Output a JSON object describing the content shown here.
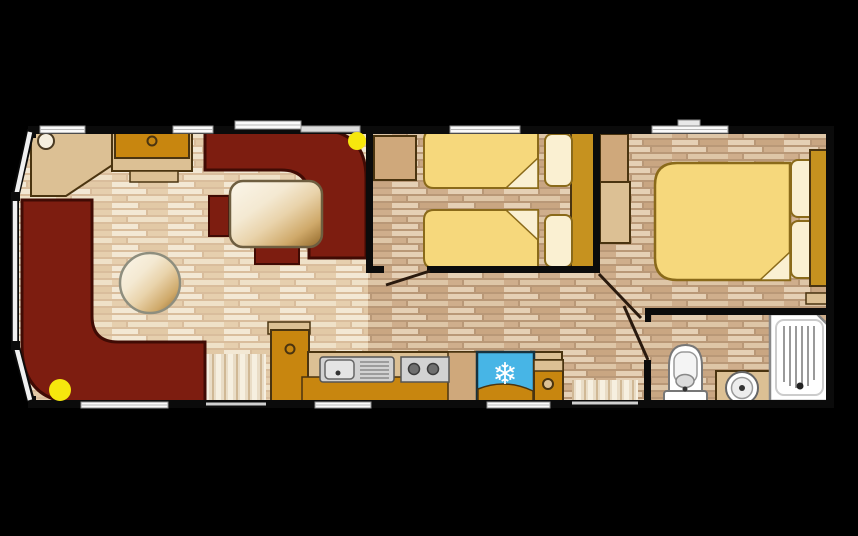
{
  "meta": {
    "type": "floor-plan",
    "subject": "static caravan holiday home floor plan, top-down view",
    "canvas": {
      "w": 858,
      "h": 536
    }
  },
  "colors": {
    "background": "#000000",
    "wall": "#0b0b0b",
    "maroon": "#7d1d10",
    "maroonDark": "#400b04",
    "gold": "#c8860f",
    "headboardGold": "#c6921f",
    "tanLight": "#dcc094",
    "tanMid": "#cfa87b",
    "outline": "#4a3410",
    "bedYellow": "#f6d87c",
    "bedOutline": "#8a6a1a",
    "cream": "#faf0d2",
    "fridgeBlue": "#47b5e6",
    "lightYellow": "#f6e70d",
    "white": "#fafafa",
    "windowFrame": "#8e8e8e",
    "fixtureGray": "#d2d2d2",
    "fixtureEdge": "#555555",
    "doorLeaf": "#2a1a0e"
  },
  "rooms": [
    {
      "name": "lounge"
    },
    {
      "name": "dining-area"
    },
    {
      "name": "kitchen"
    },
    {
      "name": "twin-bedroom"
    },
    {
      "name": "double-bedroom"
    },
    {
      "name": "bathroom"
    },
    {
      "name": "hallway"
    }
  ],
  "icons": [
    {
      "name": "fridge-snowflake-icon",
      "glyph": "❄"
    }
  ],
  "shapes": [
    {
      "n": "floor-lounge",
      "t": "path",
      "d": "M31,130 L16,197 L16,345 L31,401 L368,401 L368,130 Z",
      "fill": "url(#floorLight)"
    },
    {
      "n": "floor-bedrooms-hall",
      "t": "rect",
      "x": 368,
      "y": 130,
      "w": 460,
      "h": 272,
      "fill": "url(#floorDark)"
    },
    {
      "n": "main-door-threshold",
      "t": "rect",
      "x": 206,
      "y": 354,
      "w": 60,
      "h": 48,
      "fill": "url(#mat)"
    },
    {
      "n": "rear-door-threshold",
      "t": "rect",
      "x": 572,
      "y": 380,
      "w": 66,
      "h": 22,
      "fill": "url(#mat)"
    },
    {
      "n": "corner-shelf",
      "t": "polygon",
      "pts": "31,130 114,130 114,164 66,196 31,196",
      "fill": "$tanLight",
      "stroke": "$outline",
      "sw": 2
    },
    {
      "n": "corner-lamp",
      "t": "circle",
      "cx": 46,
      "cy": 141,
      "r": 8,
      "fill": "#f6efdf",
      "stroke": "#4a3a22",
      "sw": 2
    },
    {
      "n": "tv-unit-base",
      "t": "rect",
      "x": 112,
      "y": 130,
      "w": 80,
      "h": 41,
      "fill": "$tanLight",
      "stroke": "$outline",
      "sw": 2
    },
    {
      "n": "tv-unit",
      "t": "rect",
      "x": 115,
      "y": 132,
      "w": 74,
      "h": 26,
      "fill": "$gold",
      "stroke": "$outline",
      "sw": 2
    },
    {
      "n": "tv-unit-knob",
      "t": "circle",
      "cx": 152,
      "cy": 141,
      "r": 4.5,
      "fill": "$gold",
      "stroke": "$outline",
      "sw": 2
    },
    {
      "n": "tv-unit-step",
      "t": "rect",
      "x": 130,
      "y": 171,
      "w": 48,
      "h": 11,
      "fill": "$tanLight",
      "stroke": "$outline",
      "sw": 1.5
    },
    {
      "n": "l-shaped-sofa",
      "t": "path",
      "d": "M22,200 H92 V316 Q92,342 118,342 H205 V403 H80 Q22,403 22,345 Z",
      "fill": "$maroon",
      "stroke": "$maroonDark",
      "sw": 3
    },
    {
      "n": "dining-booth",
      "t": "path",
      "d": "M205,130 H318 Q366,130 366,178 V258 H309 V198 Q309,170 281,170 H205 Z",
      "fill": "$maroon",
      "stroke": "$maroonDark",
      "sw": 3
    },
    {
      "n": "dining-bench-left",
      "t": "rect",
      "x": 209,
      "y": 196,
      "w": 20,
      "h": 40,
      "fill": "$maroon",
      "stroke": "$maroonDark",
      "sw": 2
    },
    {
      "n": "dining-bench-stub",
      "t": "rect",
      "x": 255,
      "y": 247,
      "w": 44,
      "h": 17,
      "fill": "$maroon",
      "stroke": "$maroonDark",
      "sw": 2
    },
    {
      "n": "dining-table",
      "t": "rect",
      "x": 230,
      "y": 181,
      "w": 92,
      "h": 66,
      "rx": 13,
      "fill": "url(#woodGloss)",
      "stroke": "#6e5e40",
      "sw": 2.5
    },
    {
      "n": "round-table",
      "t": "circle",
      "cx": 150,
      "cy": 283,
      "r": 30,
      "fill": "url(#woodGloss)",
      "stroke": "#8e8e7e",
      "sw": 2.5
    },
    {
      "n": "kitchen-tall-cabinet-top",
      "t": "rect",
      "x": 268,
      "y": 322,
      "w": 42,
      "h": 12,
      "fill": "$tanLight",
      "stroke": "$outline",
      "sw": 1.5
    },
    {
      "n": "kitchen-tall-cabinet",
      "t": "rect",
      "x": 271,
      "y": 330,
      "w": 38,
      "h": 73,
      "fill": "$gold",
      "stroke": "$outline",
      "sw": 2
    },
    {
      "n": "kitchen-tall-cabinet-knob",
      "t": "circle",
      "cx": 290,
      "cy": 349,
      "r": 4.5,
      "fill": "$gold",
      "stroke": "$outline",
      "sw": 2
    },
    {
      "n": "kitchen-counter",
      "t": "rect",
      "x": 308,
      "y": 352,
      "w": 254,
      "h": 51,
      "fill": "$tanLight",
      "stroke": "$outline",
      "sw": 2
    },
    {
      "n": "kitchen-base-unit",
      "t": "rect",
      "x": 302,
      "y": 377,
      "w": 260,
      "h": 26,
      "fill": "$gold",
      "stroke": "$outline",
      "sw": 1.5
    },
    {
      "n": "kitchen-divider-unit",
      "t": "rect",
      "x": 448,
      "y": 352,
      "w": 30,
      "h": 51,
      "fill": "$tanMid",
      "stroke": "$outline",
      "sw": 1.5
    },
    {
      "n": "sink-unit",
      "t": "rect",
      "x": 320,
      "y": 357,
      "w": 74,
      "h": 25,
      "rx": 3,
      "fill": "$fixtureGray",
      "stroke": "$fixtureEdge",
      "sw": 1.5
    },
    {
      "n": "sink-bowl",
      "t": "rect",
      "x": 325,
      "y": 360,
      "w": 29,
      "h": 19,
      "rx": 4,
      "fill": "#e4e4e4",
      "stroke": "#666666",
      "sw": 1.5
    },
    {
      "n": "sink-tap",
      "t": "circle",
      "cx": 338,
      "cy": 373,
      "r": 2.5,
      "fill": "#333333"
    },
    {
      "n": "sink-drainer",
      "t": "path",
      "d": "M360,362H389M360,366H389M360,370H389M360,374H389M360,378H389",
      "stroke": "#8a8a8a",
      "sw": 1.5
    },
    {
      "n": "hob",
      "t": "rect",
      "x": 401,
      "y": 357,
      "w": 48,
      "h": 25,
      "fill": "$fixtureGray",
      "stroke": "$fixtureEdge",
      "sw": 1.5
    },
    {
      "n": "hob-burner-left",
      "t": "circle",
      "cx": 414,
      "cy": 369,
      "r": 5.5,
      "fill": "#6f6f6f",
      "stroke": "#3c3c3c",
      "sw": 1.5
    },
    {
      "n": "hob-burner-right",
      "t": "circle",
      "cx": 433,
      "cy": 369,
      "r": 5.5,
      "fill": "#6f6f6f",
      "stroke": "#3c3c3c",
      "sw": 1.5
    },
    {
      "n": "fridge",
      "t": "rect",
      "x": 477,
      "y": 352,
      "w": 57,
      "h": 51,
      "fill": "$fridgeBlue",
      "stroke": "#16323f",
      "sw": 2.5
    },
    {
      "n": "fridge-base",
      "t": "path",
      "d": "M478,402 V389 Q505,378 533,391 V402 Z",
      "fill": "$gold",
      "stroke": "$outline",
      "sw": 1.5
    },
    {
      "n": "fridge-snowflake-icon",
      "t": "text",
      "x": 505,
      "y": 384,
      "content": "❄",
      "size": 30,
      "fill": "#ffffff"
    },
    {
      "n": "kitchen-end-cabinet",
      "t": "rect",
      "x": 534,
      "y": 360,
      "w": 29,
      "h": 43,
      "fill": "$gold",
      "stroke": "$outline",
      "sw": 2
    },
    {
      "n": "kitchen-end-cabinet-top",
      "t": "rect",
      "x": 534,
      "y": 360,
      "w": 29,
      "h": 11,
      "fill": "$tanLight",
      "stroke": "$outline",
      "sw": 1.5
    },
    {
      "n": "kitchen-end-cabinet-knob",
      "t": "circle",
      "cx": 548,
      "cy": 384,
      "r": 5,
      "fill": "$tanLight",
      "stroke": "$outline",
      "sw": 2
    },
    {
      "n": "twin-bedside-cabinet",
      "t": "rect",
      "x": 374,
      "y": 136,
      "w": 42,
      "h": 44,
      "fill": "$tanMid",
      "stroke": "$outline",
      "sw": 2
    },
    {
      "n": "twin-headboard-panel",
      "t": "rect",
      "x": 571,
      "y": 130,
      "w": 25,
      "h": 138,
      "fill": "$headboardGold",
      "stroke": "$outline",
      "sw": 2
    },
    {
      "n": "twin-bed-1",
      "t": "path",
      "d": "M434,130 H538 V188 H434 Q424,188 424,178 V140 Q424,130 434,130 Z",
      "fill": "$bedYellow",
      "stroke": "$bedOutline",
      "sw": 2
    },
    {
      "n": "twin-bed-1-fold",
      "t": "polygon",
      "pts": "538,158 538,188 506,188",
      "fill": "$cream",
      "stroke": "$bedOutline",
      "sw": 1.5
    },
    {
      "n": "twin-pillow-1",
      "t": "rect",
      "x": 545,
      "y": 134,
      "w": 27,
      "h": 52,
      "rx": 7,
      "fill": "$cream",
      "stroke": "$bedOutline",
      "sw": 2
    },
    {
      "n": "twin-bed-2",
      "t": "path",
      "d": "M434,210 H538 V268 H434 Q424,268 424,258 V220 Q424,210 434,210 Z",
      "fill": "$bedYellow",
      "stroke": "$bedOutline",
      "sw": 2
    },
    {
      "n": "twin-bed-2-fold",
      "t": "polygon",
      "pts": "538,210 538,240 506,210",
      "fill": "$cream",
      "stroke": "$bedOutline",
      "sw": 1.5
    },
    {
      "n": "twin-pillow-2",
      "t": "rect",
      "x": 545,
      "y": 215,
      "w": 27,
      "h": 52,
      "rx": 7,
      "fill": "$cream",
      "stroke": "$bedOutline",
      "sw": 2
    },
    {
      "n": "double-dresser",
      "t": "rect",
      "x": 600,
      "y": 134,
      "w": 28,
      "h": 48,
      "fill": "$tanMid",
      "stroke": "$outline",
      "sw": 2
    },
    {
      "n": "double-wardrobe",
      "t": "rect",
      "x": 600,
      "y": 182,
      "w": 30,
      "h": 61,
      "fill": "$tanLight",
      "stroke": "$outline",
      "sw": 2
    },
    {
      "n": "double-bed",
      "t": "path",
      "d": "M677,163 H790 V280 H677 Q655,280 655,258 V185 Q655,163 677,163 Z",
      "fill": "$bedYellow",
      "stroke": "$bedOutline",
      "sw": 2.5
    },
    {
      "n": "double-bed-fold",
      "t": "polygon",
      "pts": "790,280 760,280 790,252",
      "fill": "$cream",
      "stroke": "$bedOutline",
      "sw": 1.5
    },
    {
      "n": "double-pillow-1",
      "t": "rect",
      "x": 791,
      "y": 160,
      "w": 27,
      "h": 57,
      "rx": 7,
      "fill": "$cream",
      "stroke": "$bedOutline",
      "sw": 2
    },
    {
      "n": "double-pillow-2",
      "t": "rect",
      "x": 791,
      "y": 221,
      "w": 27,
      "h": 57,
      "rx": 7,
      "fill": "$cream",
      "stroke": "$bedOutline",
      "sw": 2
    },
    {
      "n": "double-headboard",
      "t": "rect",
      "x": 810,
      "y": 150,
      "w": 18,
      "h": 136,
      "fill": "$headboardGold",
      "stroke": "$outline",
      "sw": 2
    },
    {
      "n": "double-bedside-shelf",
      "t": "rect",
      "x": 806,
      "y": 293,
      "w": 24,
      "h": 11,
      "fill": "$tanLight",
      "stroke": "$outline",
      "sw": 1.5
    },
    {
      "n": "toilet-cistern",
      "t": "path",
      "d": "M669,366 Q669,345 685.5,345 Q702,345 702,366 V393 H669 Z",
      "fill": "#ffffff",
      "stroke": "#777777",
      "sw": 2
    },
    {
      "n": "toilet-bowl",
      "t": "rect",
      "x": 674,
      "y": 352,
      "w": 23,
      "h": 31,
      "rx": 9,
      "fill": "#f4f4f4",
      "stroke": "#999999",
      "sw": 1.5
    },
    {
      "n": "toilet-seat",
      "t": "ellipse",
      "cx": 685,
      "cy": 381,
      "rx": 9,
      "ry": 6.5,
      "fill": "#dcdcdc",
      "stroke": "#888888",
      "sw": 1.5
    },
    {
      "n": "toilet-base",
      "t": "rect",
      "x": 664,
      "y": 391,
      "w": 43,
      "h": 12,
      "rx": 3,
      "fill": "#ffffff",
      "stroke": "#777777",
      "sw": 2
    },
    {
      "n": "toilet-base-dot",
      "t": "circle",
      "cx": 685,
      "cy": 389,
      "r": 2.5,
      "fill": "#333333"
    },
    {
      "n": "basin-cabinet",
      "t": "rect",
      "x": 716,
      "y": 371,
      "w": 54,
      "h": 33,
      "fill": "$tanLight",
      "stroke": "$outline",
      "sw": 2
    },
    {
      "n": "basin-outer",
      "t": "circle",
      "cx": 742,
      "cy": 388,
      "r": 16,
      "fill": "#ffffff",
      "stroke": "#666666",
      "sw": 2
    },
    {
      "n": "basin-inner",
      "t": "circle",
      "cx": 742,
      "cy": 388,
      "r": 10.5,
      "fill": "#ededed",
      "stroke": "#999999",
      "sw": 1.5
    },
    {
      "n": "basin-drain",
      "t": "circle",
      "cx": 742,
      "cy": 388,
      "r": 3,
      "fill": "#333333"
    },
    {
      "n": "shower-tray",
      "t": "path",
      "d": "M770,314 H817 L830,327 V401 H770 Z",
      "fill": "#ffffff",
      "stroke": "#888888",
      "sw": 2.5
    },
    {
      "n": "shower-tray-inner",
      "t": "rect",
      "x": 776,
      "y": 320,
      "w": 47,
      "h": 75,
      "rx": 8,
      "fill": "none",
      "stroke": "#cccccc",
      "sw": 2
    },
    {
      "n": "shower-ridges",
      "t": "path",
      "d": "M784,326 V382 M790,326 V386 M796,326 V388 M802,326 V388 M808,326 V386 M814,326 V380",
      "stroke": "#9a9a9a",
      "sw": 2
    },
    {
      "n": "shower-drain",
      "t": "circle",
      "cx": 800,
      "cy": 386,
      "r": 3.5,
      "fill": "#222222"
    },
    {
      "n": "wall-top",
      "t": "rect",
      "x": 28,
      "y": 126,
      "w": 806,
      "h": 8,
      "fill": "$wall"
    },
    {
      "n": "wall-bottom",
      "t": "rect",
      "x": 28,
      "y": 400,
      "w": 806,
      "h": 8,
      "fill": "$wall"
    },
    {
      "n": "wall-right",
      "t": "rect",
      "x": 826,
      "y": 126,
      "w": 8,
      "h": 282,
      "fill": "$wall"
    },
    {
      "n": "wall-left-top-stub",
      "t": "rect",
      "x": 28,
      "y": 126,
      "w": 8,
      "h": 12,
      "fill": "$wall"
    },
    {
      "n": "wall-left-bottom-stub",
      "t": "rect",
      "x": 28,
      "y": 396,
      "w": 8,
      "h": 12,
      "fill": "$wall"
    },
    {
      "n": "bay-wall-top",
      "t": "line",
      "x1": 31,
      "y1": 130,
      "x2": 15,
      "y2": 198,
      "stroke": "$wall",
      "sw": 8
    },
    {
      "n": "bay-wall-front",
      "t": "line",
      "x1": 15,
      "y1": 196,
      "x2": 15,
      "y2": 346,
      "stroke": "$wall",
      "sw": 8
    },
    {
      "n": "bay-wall-bottom",
      "t": "line",
      "x1": 15,
      "y1": 344,
      "x2": 31,
      "y2": 401,
      "stroke": "$wall",
      "sw": 8
    },
    {
      "n": "wall-lounge-twin",
      "t": "rect",
      "x": 366,
      "y": 126,
      "w": 7,
      "h": 147,
      "fill": "$wall"
    },
    {
      "n": "wall-lounge-twin-stub",
      "t": "rect",
      "x": 366,
      "y": 266,
      "w": 18,
      "h": 7,
      "fill": "$wall"
    },
    {
      "n": "wall-twin-bottom",
      "t": "rect",
      "x": 427,
      "y": 266,
      "w": 172,
      "h": 7,
      "fill": "$wall"
    },
    {
      "n": "wall-twin-double",
      "t": "rect",
      "x": 593,
      "y": 126,
      "w": 7,
      "h": 147,
      "fill": "$wall"
    },
    {
      "n": "wall-bathroom-top",
      "t": "rect",
      "x": 645,
      "y": 308,
      "w": 187,
      "h": 7,
      "fill": "$wall"
    },
    {
      "n": "wall-bathroom-top-stub",
      "t": "rect",
      "x": 645,
      "y": 308,
      "w": 6,
      "h": 14,
      "fill": "$wall"
    },
    {
      "n": "wall-bathroom-left",
      "t": "rect",
      "x": 644,
      "y": 360,
      "w": 7,
      "h": 46,
      "fill": "$wall"
    },
    {
      "n": "bay-window-top",
      "t": "line",
      "x1": 30,
      "y1": 132,
      "x2": 16,
      "y2": 196,
      "stroke": "#f0f0f0",
      "sw": 4.5
    },
    {
      "n": "bay-window-front",
      "t": "line",
      "x1": 15,
      "y1": 199,
      "x2": 15,
      "y2": 343,
      "stroke": "#f0f0f0",
      "sw": 4.5
    },
    {
      "n": "bay-window-bottom",
      "t": "line",
      "x1": 16,
      "y1": 346,
      "x2": 30,
      "y2": 400,
      "stroke": "#f0f0f0",
      "sw": 4.5
    },
    {
      "n": "bay-window-joint-top",
      "t": "rect",
      "x": 11,
      "y": 192,
      "w": 9,
      "h": 9,
      "fill": "$wall"
    },
    {
      "n": "bay-window-joint-bottom",
      "t": "rect",
      "x": 11,
      "y": 341,
      "w": 9,
      "h": 9,
      "fill": "$wall"
    },
    {
      "n": "window-lounge-left",
      "t": "rect",
      "x": 40,
      "y": 126,
      "w": 45,
      "h": 7,
      "fill": "$white",
      "stroke": "$windowFrame",
      "sw": 1
    },
    {
      "n": "window-tv-unit",
      "t": "rect",
      "x": 173,
      "y": 126,
      "w": 40,
      "h": 7,
      "fill": "$white",
      "stroke": "$windowFrame",
      "sw": 1
    },
    {
      "n": "window-dining",
      "t": "rect",
      "x": 235,
      "y": 121,
      "w": 66,
      "h": 8,
      "fill": "$white",
      "stroke": "$windowFrame",
      "sw": 1
    },
    {
      "n": "window-dining-2",
      "t": "rect",
      "x": 301,
      "y": 126,
      "w": 59,
      "h": 6,
      "fill": "#dcdcdc",
      "stroke": "$windowFrame",
      "sw": 1
    },
    {
      "n": "window-twin-bedroom",
      "t": "rect",
      "x": 450,
      "y": 126,
      "w": 70,
      "h": 7,
      "fill": "$white",
      "stroke": "$windowFrame",
      "sw": 1
    },
    {
      "n": "window-double-bedroom",
      "t": "rect",
      "x": 652,
      "y": 126,
      "w": 76,
      "h": 7,
      "fill": "$white",
      "stroke": "$windowFrame",
      "sw": 1
    },
    {
      "n": "roof-vent",
      "t": "rect",
      "x": 678,
      "y": 120,
      "w": 22,
      "h": 6,
      "fill": "#e8e8e8",
      "stroke": "#888888",
      "sw": 1
    },
    {
      "n": "window-lounge-bottom",
      "t": "rect",
      "x": 81,
      "y": 402,
      "w": 87,
      "h": 6,
      "fill": "$white",
      "stroke": "$windowFrame",
      "sw": 1
    },
    {
      "n": "window-kitchen-bottom",
      "t": "rect",
      "x": 315,
      "y": 402,
      "w": 56,
      "h": 6,
      "fill": "$white",
      "stroke": "$windowFrame",
      "sw": 1
    },
    {
      "n": "window-fridge-bottom",
      "t": "rect",
      "x": 487,
      "y": 402,
      "w": 63,
      "h": 6,
      "fill": "$white",
      "stroke": "$windowFrame",
      "sw": 1
    },
    {
      "n": "window-midlines",
      "t": "path",
      "d": "M40,129.5H85M173,129.5H213M235,125H301M450,129.5H520M652,129.5H728M81,405H168M315,405H371M487,405H550",
      "stroke": "#b8b8b8",
      "sw": 1
    },
    {
      "n": "main-door-sill",
      "t": "line",
      "x1": 206,
      "y1": 404,
      "x2": 266,
      "y2": 404,
      "stroke": "#cfcfcf",
      "sw": 3
    },
    {
      "n": "rear-door-sill",
      "t": "line",
      "x1": 572,
      "y1": 403,
      "x2": 638,
      "y2": 403,
      "stroke": "#cfcfcf",
      "sw": 3
    },
    {
      "n": "twin-bedroom-door-leaf",
      "t": "line",
      "x1": 386,
      "y1": 285,
      "x2": 430,
      "y2": 271,
      "stroke": "$doorLeaf",
      "sw": 3
    },
    {
      "n": "double-bedroom-door-leaf",
      "t": "line",
      "x1": 599,
      "y1": 274,
      "x2": 641,
      "y2": 318,
      "stroke": "$doorLeaf",
      "sw": 3
    },
    {
      "n": "bathroom-door-leaf",
      "t": "line",
      "x1": 648,
      "y1": 360,
      "x2": 624,
      "y2": 306,
      "stroke": "$doorLeaf",
      "sw": 3
    },
    {
      "n": "lounge-ceiling-light",
      "t": "circle",
      "cx": 60,
      "cy": 390,
      "r": 11,
      "fill": "$lightYellow"
    },
    {
      "n": "dining-ceiling-light",
      "t": "circle",
      "cx": 357,
      "cy": 141,
      "r": 9,
      "fill": "$lightYellow"
    }
  ]
}
